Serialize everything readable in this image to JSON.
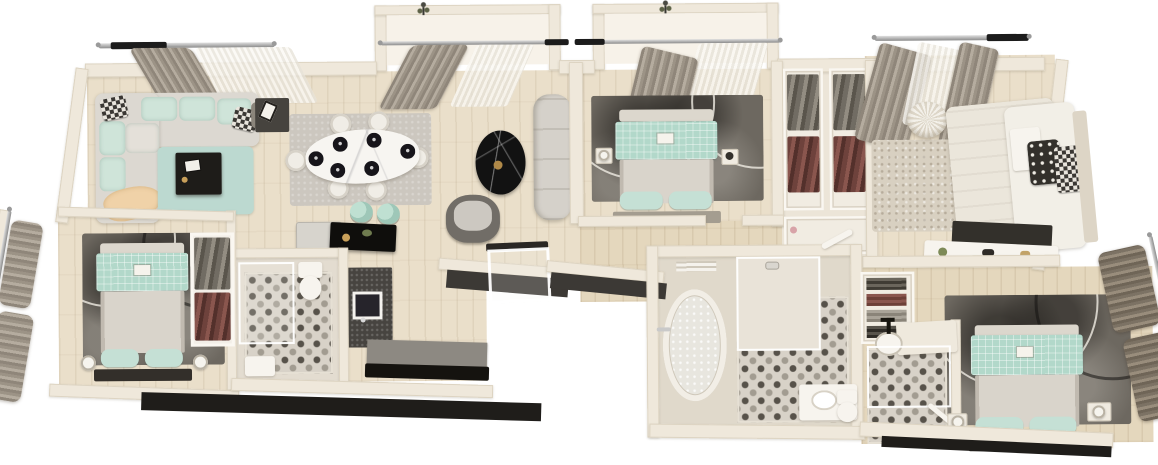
{
  "scene": {
    "type": "3d-rendered-apartment-floor-plan",
    "view": "top-down axonometric render",
    "background": "#ffffff",
    "style": "modern interior in mint, taupe and cream tones",
    "visible_text": ""
  },
  "palette": {
    "background": "#ffffff",
    "wall_top": "#efe8db",
    "wall_face_shadow": "#3c3935",
    "wall_face_black": "#1f1d1a",
    "wood_floor": "#eadfca",
    "wood_floor_tan": "#e4d7bd",
    "tile_base": "#d8d2c8",
    "tile_dot_dark": "#57524a",
    "tile_dot_light": "#a29c91",
    "mint_textile": "#b2d8ca",
    "mint_cushion": "#cfe4d9",
    "teal_rug": "#bcd9d0",
    "dark_area_rug": "#6d6860",
    "taupe_curtain": "#9c9386",
    "sheer_curtain": "#f1ede6",
    "gray_sofa": "#dcd8d1",
    "black_furniture": "#15130f",
    "counter_gray": "#8d8982",
    "maroon_clothes": "#6e423c",
    "peach_throw": "#f0d2a8",
    "white_marble": "#f7f5f1",
    "black_marble": "#121212"
  },
  "rooms": [
    {
      "id": "living-room",
      "label": "living room",
      "items": [
        "corner-sectional-sofa-mint-gray",
        "checkered-pillows",
        "peach-throw-blanket",
        "teal-rug",
        "black-coffee-table",
        "side-table-with-frame",
        "window-curtain-rod",
        "gray-and-sheer-curtains"
      ]
    },
    {
      "id": "dining-area",
      "label": "dining area",
      "items": [
        "white-marble-oval-table",
        "six-white-chairs",
        "six-black-place-settings",
        "gray-rug",
        "balcony-bay-with-sheer-curtains",
        "plant-on-sill"
      ]
    },
    {
      "id": "kitchen",
      "label": "kitchen",
      "items": [
        "black-island-bar",
        "two-mint-bar-stools",
        "fridge-cabinet",
        "dark-counter-with-sink",
        "long-base-cabinet"
      ]
    },
    {
      "id": "guest-bathroom",
      "label": "guest bathroom",
      "items": [
        "mosaic-tile-floor",
        "toilet",
        "glass-shower",
        "bath-mat"
      ]
    },
    {
      "id": "bedroom-bottom-left",
      "label": "bedroom (bottom left)",
      "items": [
        "double-bed-mint-blanket",
        "dark-patterned-rug",
        "open-wardrobe-hanging-clothes",
        "two-bedside-lamps",
        "window-bay-taupe-curtains"
      ]
    },
    {
      "id": "foyer",
      "label": "entry foyer",
      "items": [
        "black-marble-side-table",
        "gray-armchair",
        "long-gray-bench-sofa",
        "glass-entry-door"
      ]
    },
    {
      "id": "bedroom-top-center",
      "label": "bedroom (top center)",
      "items": [
        "double-bed-mint-blanket",
        "dark-patterned-rug",
        "balcony-bay-with-curtains",
        "two-nightstands",
        "bedside-lamp"
      ]
    },
    {
      "id": "walk-in-closet",
      "label": "walk-in closet",
      "items": [
        "hanging-gray-clothes",
        "hanging-maroon-clothes",
        "white-shelf-units"
      ]
    },
    {
      "id": "bedroom-top-right",
      "label": "bedroom (top right)",
      "items": [
        "cream-double-bed",
        "polka-dot-pillow",
        "checkered-pillow",
        "round-tufted-pouf",
        "speckled-rug",
        "taupe-curtains",
        "dark-desk",
        "white-shelf-with-accessories"
      ]
    },
    {
      "id": "main-bathroom",
      "label": "main bathroom",
      "items": [
        "freestanding-oval-bathtub",
        "walk-in-glass-shower",
        "mosaic-tile-floor",
        "vanity-with-basin",
        "toilet",
        "towel-rail",
        "door-leaf"
      ]
    },
    {
      "id": "bedroom-bottom-right",
      "label": "bedroom (bottom right)",
      "items": [
        "double-bed-mint-blanket",
        "dark-patterned-rug",
        "ensuite-shower-room",
        "basin-with-black-faucet",
        "mosaic-tile-floor",
        "folded-clothes-shelf",
        "two-bedside-lamps",
        "dark-taupe-curtains"
      ]
    }
  ]
}
